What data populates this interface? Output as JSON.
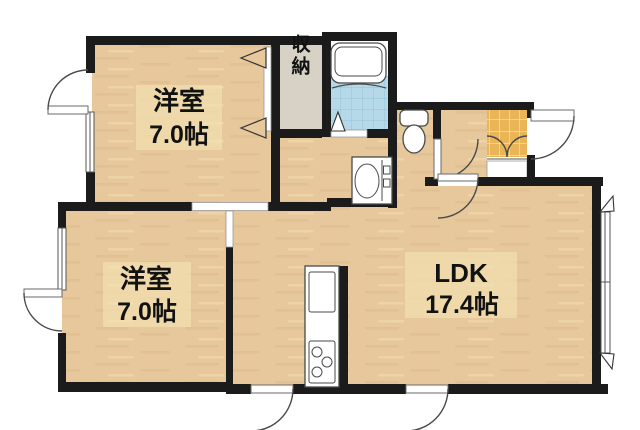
{
  "plan": {
    "bedroom1": {
      "label": "洋室",
      "size": "7.0帖"
    },
    "bedroom2": {
      "label": "洋室",
      "size": "7.0帖"
    },
    "ldk": {
      "label": "LDK",
      "size": "17.4帖"
    },
    "closet": {
      "label": "収納"
    }
  },
  "icons": {
    "bathtub": "bathtub-icon",
    "toilet": "toilet-icon",
    "washbasin": "washbasin-icon",
    "kitchen_sink": "kitchen-sink-icon",
    "stove": "stove-burners-icon",
    "door_swing": "door-swing-arc",
    "sliding_window": "sliding-window",
    "entrance_tile": "entrance-tile"
  },
  "colors": {
    "wall": "#1b1b1b",
    "wood": "#e6c89c",
    "wood_streak": "#d9b583",
    "closet": "#d7d2c5",
    "bath_tile": "#b5d9e9",
    "bath_tile_line": "#95c2d6",
    "entry_tile": "#e9b557",
    "entry_tile_line": "#f6e0a9",
    "label_bg": "#f3e4b5",
    "line": "#4a4a4a"
  }
}
